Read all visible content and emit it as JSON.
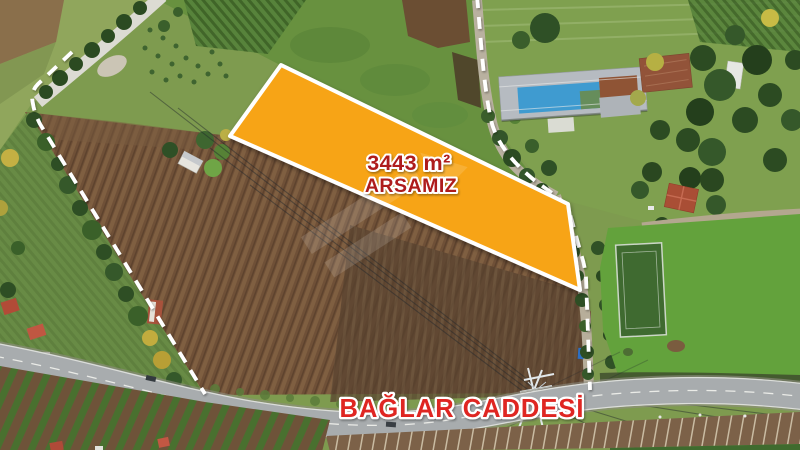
{
  "meta": {
    "type": "aerial-real-estate-photo",
    "width_px": 800,
    "height_px": 450
  },
  "listing": {
    "area_label": "3443 m²",
    "parcel_label": "ARSAMIZ",
    "street_label": "BAĞLAR CADDESİ"
  },
  "colors": {
    "parcel_fill": "#F7A418",
    "parcel_border": "#FFFFFF",
    "parcel_text": "#AE1A1E",
    "street_text": "#DF2722",
    "label_outline": "#FFFFFF",
    "boundary_dash": "#FFFFFF",
    "plowed_field": "#6F5037",
    "asphalt_road": "#A8ACAE"
  }
}
